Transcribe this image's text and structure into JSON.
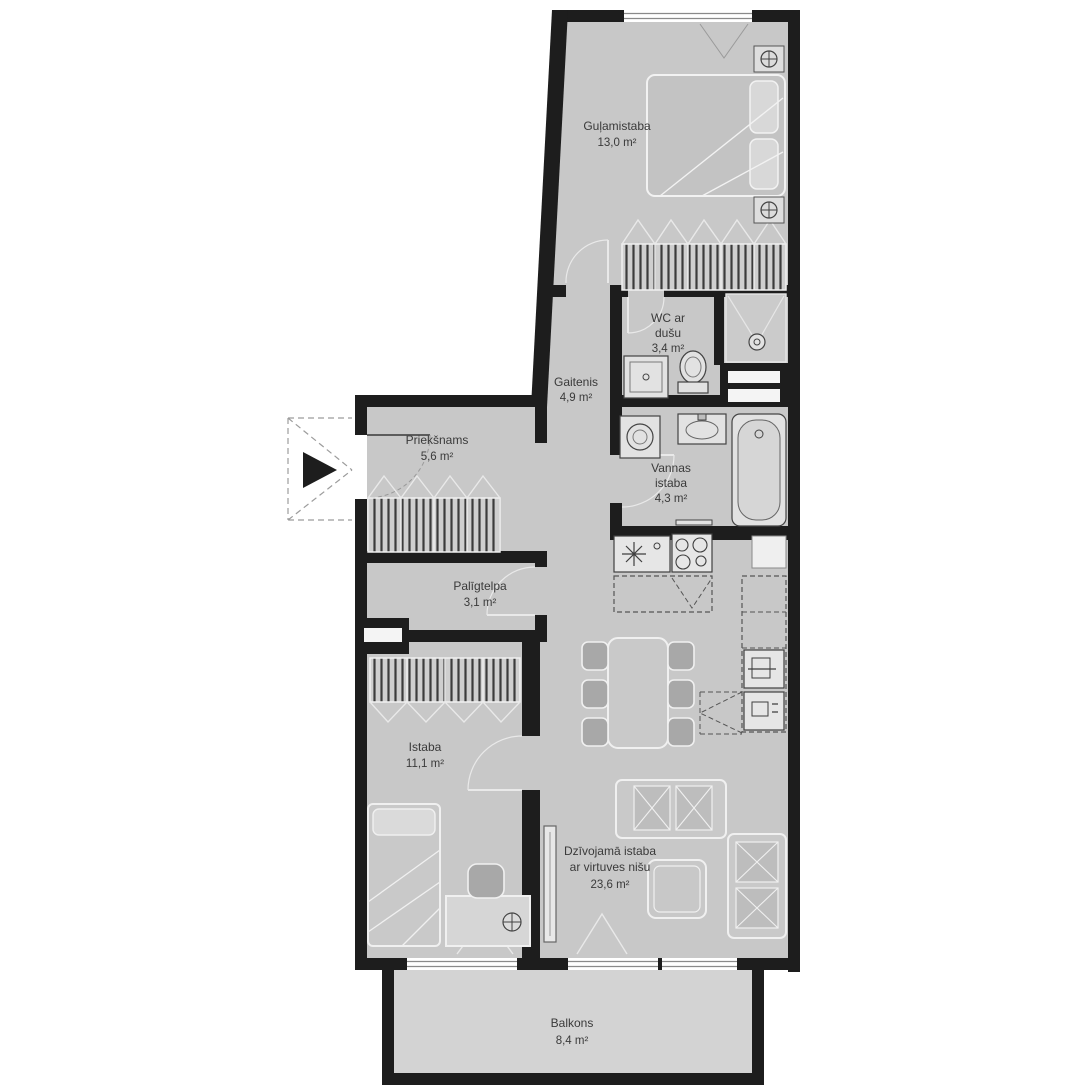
{
  "plan": {
    "type": "apartment-floor-plan",
    "language": "Latvian",
    "unit": "m²",
    "colors": {
      "wall": "#1d1d1d",
      "floor": "#c8c8c8",
      "balcony_floor": "#d3d3d3",
      "furniture_outline": "#f0f0f0",
      "appliance_stroke": "#3f3f3f",
      "text": "#3a3a3a"
    },
    "rooms": [
      {
        "id": "bedroom",
        "name": "Guļamistaba",
        "area": "13,0 m²",
        "lines": [
          "Guļamistaba",
          "13,0 m²"
        ]
      },
      {
        "id": "wc",
        "name": "WC ar dušu",
        "area": "3,4 m²",
        "lines": [
          "WC ar",
          "dušu",
          "3,4 m²"
        ]
      },
      {
        "id": "corridor",
        "name": "Gaitenis",
        "area": "4,9 m²",
        "lines": [
          "Gaitenis",
          "4,9 m²"
        ]
      },
      {
        "id": "entry",
        "name": "Priekšnams",
        "area": "5,6 m²",
        "lines": [
          "Priekšnams",
          "5,6 m²"
        ]
      },
      {
        "id": "bathroom",
        "name": "Vannas istaba",
        "area": "4,3 m²",
        "lines": [
          "Vannas",
          "istaba",
          "4,3 m²"
        ]
      },
      {
        "id": "utility",
        "name": "Palīgtelpa",
        "area": "3,1 m²",
        "lines": [
          "Palīgtelpa",
          "3,1 m²"
        ]
      },
      {
        "id": "room",
        "name": "Istaba",
        "area": "11,1 m²",
        "lines": [
          "Istaba",
          "11,1 m²"
        ]
      },
      {
        "id": "living",
        "name": "Dzīvojamā istaba ar virtuves nišu",
        "area": "23,6 m²",
        "lines": [
          "Dzīvojamā istaba",
          "ar virtuves nišu",
          "23,6 m²"
        ]
      },
      {
        "id": "balcony",
        "name": "Balkons",
        "area": "8,4 m²",
        "lines": [
          "Balkons",
          "8,4 m²"
        ]
      }
    ]
  }
}
